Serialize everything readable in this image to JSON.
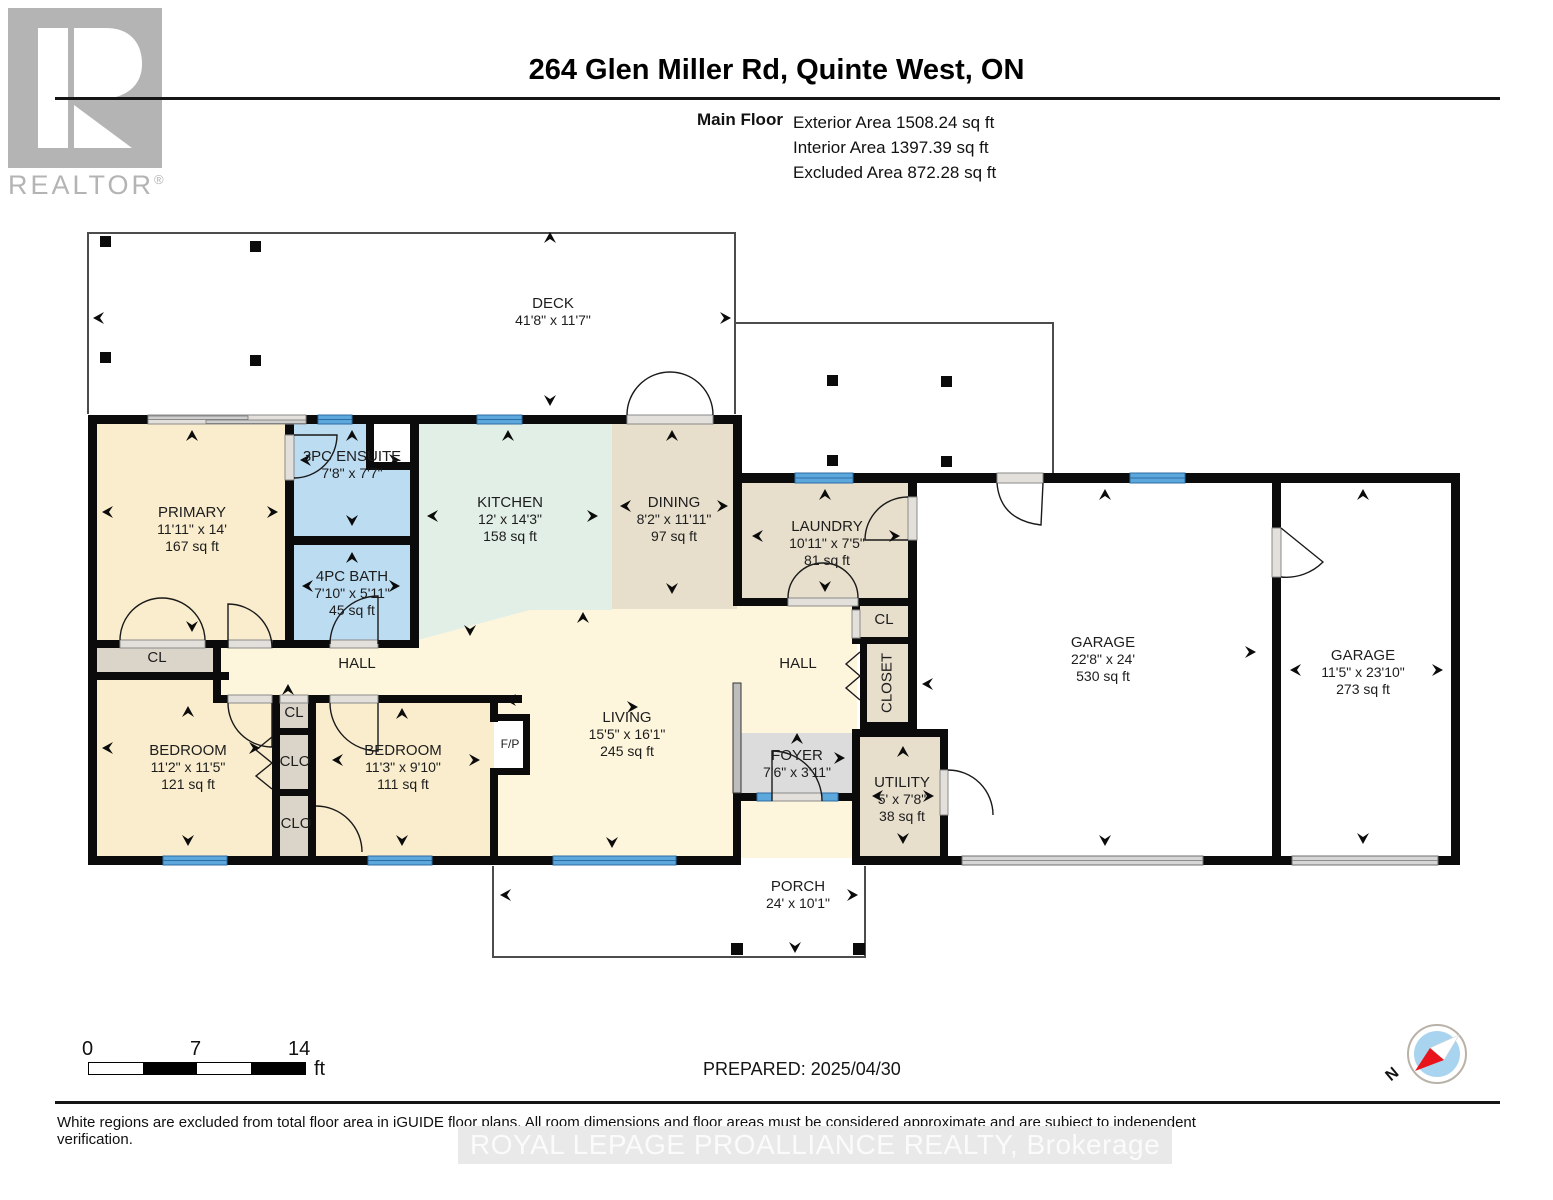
{
  "header": {
    "logo_letter": "R",
    "logo_brand": "REALTOR",
    "logo_registered": "®",
    "title": "264 Glen Miller Rd, Quinte West, ON",
    "floor_label": "Main Floor",
    "exterior": "Exterior Area 1508.24 sq ft",
    "interior": "Interior Area 1397.39 sq ft",
    "excluded": "Excluded Area 872.28 sq ft"
  },
  "rooms": {
    "deck": {
      "name": "DECK",
      "dims": "41'8\" x 11'7\""
    },
    "primary": {
      "name": "PRIMARY",
      "dims": "11'11\" x 14'",
      "area": "167 sq ft"
    },
    "ensuite": {
      "name": "3PC ENSUITE",
      "dims": "7'8\" x 7'7\""
    },
    "bath": {
      "name": "4PC BATH",
      "dims": "7'10\" x 5'11\"",
      "area": "45 sq ft"
    },
    "kitchen": {
      "name": "KITCHEN",
      "dims": "12' x 14'3\"",
      "area": "158 sq ft"
    },
    "dining": {
      "name": "DINING",
      "dims": "8'2\" x 11'11\"",
      "area": "97 sq ft"
    },
    "laundry": {
      "name": "LAUNDRY",
      "dims": "10'11\" x 7'5\"",
      "area": "81 sq ft"
    },
    "hall_left": {
      "name": "HALL"
    },
    "hall_right": {
      "name": "HALL"
    },
    "cl_primary": {
      "name": "CL"
    },
    "bedroom1": {
      "name": "BEDROOM",
      "dims": "11'2\" x 11'5\"",
      "area": "121 sq ft"
    },
    "cl_mid": {
      "name": "CL"
    },
    "clo_upper": {
      "name": "CLO"
    },
    "clo_lower": {
      "name": "CLO"
    },
    "bedroom2": {
      "name": "BEDROOM",
      "dims": "11'3\" x 9'10\"",
      "area": "111 sq ft"
    },
    "fireplace": {
      "name": "F/P"
    },
    "living": {
      "name": "LIVING",
      "dims": "15'5\" x 16'1\"",
      "area": "245 sq ft"
    },
    "foyer": {
      "name": "FOYER",
      "dims": "7'6\" x 3'11\""
    },
    "cl_right": {
      "name": "CL"
    },
    "closet": {
      "name": "CLOSET"
    },
    "utility": {
      "name": "UTILITY",
      "dims": "5' x 7'8\"",
      "area": "38 sq ft"
    },
    "garage1": {
      "name": "GARAGE",
      "dims": "22'8\" x 24'",
      "area": "530 sq ft"
    },
    "garage2": {
      "name": "GARAGE",
      "dims": "11'5\" x 23'10\"",
      "area": "273 sq ft"
    },
    "porch": {
      "name": "PORCH",
      "dims": "24' x 10'1\""
    }
  },
  "footer": {
    "scale_start": "0",
    "scale_mid": "7",
    "scale_end": "14",
    "scale_unit": "ft",
    "prepared": "PREPARED: 2025/04/30",
    "compass_n": "N",
    "disclaimer": "White regions are excluded from total floor area in iGUIDE floor plans. All room dimensions and floor areas must be considered approximate and are subject to independent verification.",
    "watermark": "ROYAL LEPAGE PROALLIANCE REALTY, Brokerage"
  },
  "colors": {
    "wall": "#0b0b0b",
    "room_cream": "#f9edcd",
    "hall_pale": "#fdf6dc",
    "kitchen_mint": "#e2efe7",
    "tan": "#e7dfcc",
    "closet_gray": "#dbd5c9",
    "foyer_gray": "#dcdcdc",
    "bath_blue": "#bcdcf2",
    "window_blue": "#5ca8dc",
    "logo_gray": "#b4b4b4",
    "compass_blue": "#a8d4f0",
    "compass_red": "#e8131b"
  }
}
